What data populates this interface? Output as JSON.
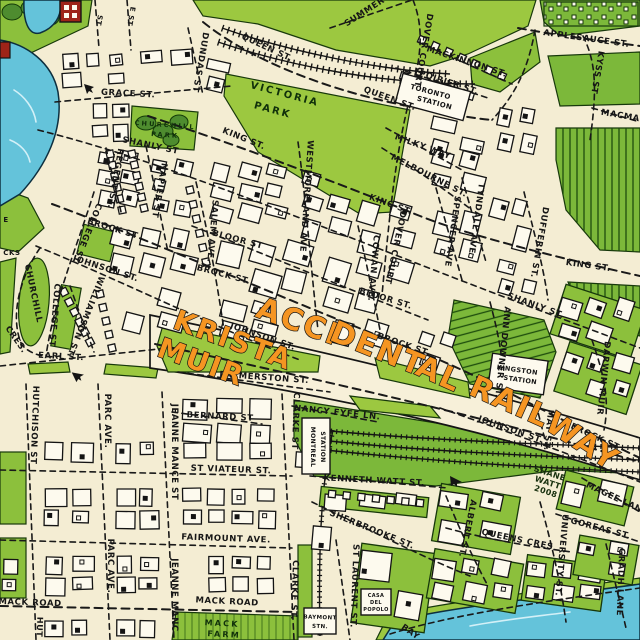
{
  "map": {
    "title_words": [
      {
        "t": "ACCI",
        "x": 295,
        "y": 331,
        "r": 20,
        "s": 30
      },
      {
        "t": "DENT",
        "x": 374,
        "y": 358,
        "r": 22,
        "s": 30
      },
      {
        "t": "AL",
        "x": 435,
        "y": 383,
        "r": 24,
        "s": 30
      },
      {
        "t": "RAIL",
        "x": 506,
        "y": 411,
        "r": 24,
        "s": 30
      },
      {
        "t": "WAY",
        "x": 577,
        "y": 450,
        "r": 33,
        "s": 30
      }
    ],
    "artist_words": [
      {
        "t": "KRISTA",
        "x": 230,
        "y": 349,
        "r": 20,
        "s": 28
      },
      {
        "t": "MUIR",
        "x": 198,
        "y": 371,
        "r": 20,
        "s": 28
      }
    ],
    "signature": [
      {
        "t": "SHANE",
        "x": 549,
        "y": 476,
        "r": 18,
        "s": 8
      },
      {
        "t": "WATT",
        "x": 547,
        "y": 485,
        "r": 18,
        "s": 8
      },
      {
        "t": "2008",
        "x": 545,
        "y": 494,
        "r": 18,
        "s": 8
      }
    ],
    "parks": [
      {
        "t": "VICTORIA",
        "x": 284,
        "y": 97,
        "r": 15,
        "s": 10
      },
      {
        "t": "PARK",
        "x": 272,
        "y": 113,
        "r": 15,
        "s": 10
      },
      {
        "t": "CHURCHILL",
        "x": 165,
        "y": 127,
        "r": 4,
        "s": 6.5
      },
      {
        "t": "PARK",
        "x": 165,
        "y": 137,
        "r": 4,
        "s": 6.5
      },
      {
        "t": "MACK",
        "x": 222,
        "y": 626,
        "r": 3,
        "s": 8
      },
      {
        "t": "FARM",
        "x": 224,
        "y": 637,
        "r": 3,
        "s": 8
      }
    ],
    "stations": [
      {
        "id": "toronto",
        "lines": [
          "TORONTO",
          "STATION"
        ]
      },
      {
        "id": "kingston",
        "lines": [
          "KINGSTON",
          "STATION"
        ]
      },
      {
        "id": "montreal",
        "lines": [
          "MONTREAL",
          "STATION"
        ]
      },
      {
        "id": "baymont",
        "lines": [
          "BAYMONT",
          "STN."
        ]
      }
    ],
    "poi": [
      {
        "id": "casa",
        "lines": [
          "CASA",
          "DEL",
          "POPOLO"
        ]
      }
    ],
    "streets": [
      {
        "t": "GRACE ST.",
        "x": 128,
        "y": 96,
        "r": 3
      },
      {
        "t": "QUEEN ST.",
        "x": 266,
        "y": 50,
        "r": 25
      },
      {
        "t": "QUEEN ST.",
        "x": 389,
        "y": 101,
        "r": 20
      },
      {
        "t": "DUNDAS ST",
        "x": 198,
        "y": 62,
        "r": 100
      },
      {
        "t": "MACKINNON ST.",
        "x": 466,
        "y": 64,
        "r": 18,
        "sp": 1.6
      },
      {
        "t": "POIRIER ST.",
        "x": 448,
        "y": 85,
        "r": 18
      },
      {
        "t": "APPLESAUCE ST.",
        "x": 586,
        "y": 41,
        "r": 8
      },
      {
        "t": "MACMA",
        "x": 620,
        "y": 118,
        "r": 10
      },
      {
        "t": "KYSS ST",
        "x": 595,
        "y": 72,
        "r": 100
      },
      {
        "t": "SUMMER",
        "x": 366,
        "y": 14,
        "r": -33
      },
      {
        "t": "DOVER COURT",
        "x": 421,
        "y": 50,
        "r": 100
      },
      {
        "t": "KING ST.",
        "x": 243,
        "y": 141,
        "r": 22
      },
      {
        "t": "SHANLY ST",
        "x": 150,
        "y": 148,
        "r": 12
      },
      {
        "t": "MILKY WAY",
        "x": 422,
        "y": 149,
        "r": 20
      },
      {
        "t": "MELBOURNE ST.",
        "x": 428,
        "y": 178,
        "r": 27
      },
      {
        "t": "KING ST.",
        "x": 390,
        "y": 207,
        "r": 20
      },
      {
        "t": "KING ST.",
        "x": 588,
        "y": 268,
        "r": 8
      },
      {
        "t": "SHANLY ST.",
        "x": 535,
        "y": 308,
        "r": 20
      },
      {
        "t": "NAPIER ST",
        "x": 157,
        "y": 190,
        "r": 100
      },
      {
        "t": "REGENT ST.",
        "x": 113,
        "y": 178,
        "r": 100
      },
      {
        "t": "SALEM AVE.",
        "x": 210,
        "y": 231,
        "r": 95
      },
      {
        "t": "WESTMORELAND AVE",
        "x": 304,
        "y": 196,
        "r": 94
      },
      {
        "t": "DOVER COURT",
        "x": 393,
        "y": 247,
        "r": 102
      },
      {
        "t": "COWAN AVE.",
        "x": 371,
        "y": 268,
        "r": 95
      },
      {
        "t": "SPENCER AVE",
        "x": 450,
        "y": 231,
        "r": 98
      },
      {
        "t": "TYNDALL AVE",
        "x": 474,
        "y": 218,
        "r": 98
      },
      {
        "t": "DUFFERIN ST.",
        "x": 537,
        "y": 242,
        "r": 100
      },
      {
        "t": "BLOOR ST",
        "x": 237,
        "y": 242,
        "r": 15
      },
      {
        "t": "BLOOR ST.",
        "x": 385,
        "y": 301,
        "r": 17
      },
      {
        "t": "BROCK ST",
        "x": 112,
        "y": 231,
        "r": 17
      },
      {
        "t": "BROCK ST.",
        "x": 223,
        "y": 277,
        "r": 15
      },
      {
        "t": "BROCK ST.",
        "x": 403,
        "y": 347,
        "r": 19
      },
      {
        "t": "BROCK ST",
        "x": 594,
        "y": 439,
        "r": 25
      },
      {
        "t": "JOHNSON ST.",
        "x": 105,
        "y": 271,
        "r": 18
      },
      {
        "t": "JOHNSON ST.",
        "x": 262,
        "y": 339,
        "r": 19
      },
      {
        "t": "JOHNSON ST.",
        "x": 510,
        "y": 432,
        "r": 19
      },
      {
        "t": "COLLEGE ST",
        "x": 85,
        "y": 232,
        "r": 112
      },
      {
        "t": "COLLEGE ST",
        "x": 52,
        "y": 315,
        "r": 95
      },
      {
        "t": "WILLIAMSON ST.",
        "x": 83,
        "y": 316,
        "r": 112
      },
      {
        "t": "CHURCHILL",
        "x": 31,
        "y": 294,
        "r": 78,
        "sp": 1.2
      },
      {
        "t": "CRES.",
        "x": 14,
        "y": 341,
        "r": 55
      },
      {
        "t": "EARL ST.",
        "x": 61,
        "y": 359,
        "r": 3
      },
      {
        "t": "ANN DOWNER ST.",
        "x": 500,
        "y": 352,
        "r": 96
      },
      {
        "t": "DARWIN MUIR",
        "x": 601,
        "y": 378,
        "r": 96
      },
      {
        "t": "MAY ST.",
        "x": 546,
        "y": 430,
        "r": 96
      },
      {
        "t": "PALMERSTON ST.",
        "x": 264,
        "y": 380,
        "r": 4
      },
      {
        "t": "BERNARD ST",
        "x": 220,
        "y": 419,
        "r": 3
      },
      {
        "t": "NANCY FYFE LN.",
        "x": 337,
        "y": 415,
        "r": 6
      },
      {
        "t": "CLARKE ST",
        "x": 293,
        "y": 421,
        "r": 92
      },
      {
        "t": "CLARKE ST.",
        "x": 292,
        "y": 590,
        "r": 92
      },
      {
        "t": "JEANNE MANCE ST",
        "x": 172,
        "y": 452,
        "r": 90
      },
      {
        "t": "JEANNE MANC",
        "x": 172,
        "y": 595,
        "r": 90
      },
      {
        "t": "PARC AVE.",
        "x": 105,
        "y": 421,
        "r": 90
      },
      {
        "t": "PARC AVE.",
        "x": 108,
        "y": 566,
        "r": 90
      },
      {
        "t": "HUTCHISON ST",
        "x": 32,
        "y": 425,
        "r": 92
      },
      {
        "t": "ST VIATEUR ST.",
        "x": 231,
        "y": 472,
        "r": 2
      },
      {
        "t": "FAIRMOUNT AVE.",
        "x": 226,
        "y": 541,
        "r": 2
      },
      {
        "t": "MACK ROAD",
        "x": 30,
        "y": 605,
        "r": 2
      },
      {
        "t": "MACK ROAD",
        "x": 227,
        "y": 604,
        "r": 3
      },
      {
        "t": "KENNETH WATT ST.",
        "x": 374,
        "y": 483,
        "r": 3
      },
      {
        "t": "SHERBROOKE ST.",
        "x": 371,
        "y": 532,
        "r": 22
      },
      {
        "t": "ST LAURENT ST.",
        "x": 352,
        "y": 586,
        "r": 92
      },
      {
        "t": "ALBERT ST.",
        "x": 465,
        "y": 528,
        "r": 102
      },
      {
        "t": "UNIVERSITY ST.",
        "x": 559,
        "y": 555,
        "r": 95
      },
      {
        "t": "QUEENS CRES",
        "x": 517,
        "y": 542,
        "r": 12
      },
      {
        "t": "MAGEE LANE",
        "x": 616,
        "y": 501,
        "r": 25
      },
      {
        "t": "GOREAS ST.",
        "x": 600,
        "y": 531,
        "r": 15
      },
      {
        "t": "GRADH LANE",
        "x": 618,
        "y": 582,
        "r": 92
      },
      {
        "t": "BAY",
        "x": 409,
        "y": 634,
        "r": 35
      }
    ],
    "partial_labels": [
      {
        "t": "ST",
        "x": 97,
        "y": 20,
        "r": 100,
        "s": 7
      },
      {
        "t": "E ST",
        "x": 129,
        "y": 16,
        "r": 100,
        "s": 7
      },
      {
        "t": "E",
        "x": 6,
        "y": 222,
        "r": 0,
        "s": 7
      },
      {
        "t": "CKS",
        "x": 12,
        "y": 255,
        "r": 0,
        "s": 7
      },
      {
        "t": "HUT",
        "x": 37,
        "y": 627,
        "r": 92,
        "s": 8
      }
    ]
  },
  "colors": {
    "background": "#f4edd3",
    "park_green": "#9cc840",
    "field_green": "#7cb83a",
    "water": "#64c3da",
    "ink": "#191919",
    "highway_orange": "#f59522",
    "building": "#fdfaee",
    "red_building": "#9e2418"
  }
}
